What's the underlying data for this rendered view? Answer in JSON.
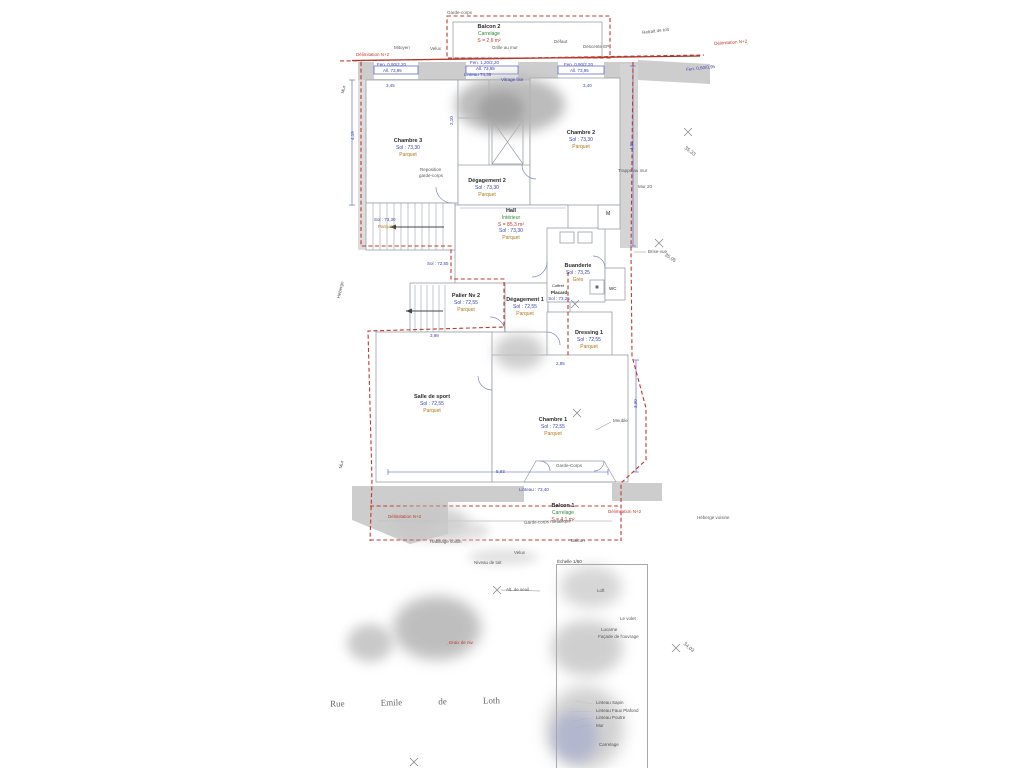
{
  "plan_colors": {
    "boundary_red": "#c0392b",
    "dimension_blue": "#3a46b4",
    "material_orange": "#b07818",
    "surface_green": "#2e8b3a",
    "wall_gray": "#cdcdcd"
  },
  "rooms": {
    "balcon2": {
      "name": "Balcon 2",
      "mat": "Carrelage",
      "surf": "S = 2,6 m²"
    },
    "chambre3": {
      "name": "Chambre 3",
      "area": "Sol : 73,30",
      "floor": "Parquet"
    },
    "chambre2": {
      "name": "Chambre 2",
      "area": "Sol : 73,30",
      "floor": "Parquet"
    },
    "degagement2": {
      "name": "Dégagement 2",
      "area": "Sol : 73,30",
      "floor": "Parquet"
    },
    "hall": {
      "name": "Hall",
      "mat": "Intérieur",
      "surf": "S = 85,3 m²",
      "area": "Sol : 73,30",
      "floor": "Parquet"
    },
    "palier": {
      "name": "Palier Nv 2",
      "area": "Sol : 72,55",
      "floor": "Parquet"
    },
    "degagement1": {
      "name": "Dégagement 1",
      "area": "Sol : 72,55",
      "floor": "Parquet"
    },
    "placard": {
      "name": "Placard",
      "area": "Sol : 73,25"
    },
    "buanderie": {
      "name": "Buanderie",
      "area": "Sol : 73,25",
      "floor": "Grès"
    },
    "dressing": {
      "name": "Dressing 1",
      "area": "Sol : 72,55",
      "floor": "Parquet"
    },
    "sport": {
      "name": "Salle de sport",
      "area": "Sol : 72,55",
      "floor": "Parquet"
    },
    "chambre1": {
      "name": "Chambre 1",
      "area": "Sol : 72,55",
      "floor": "Parquet"
    },
    "balcon1": {
      "name": "Balcon 1",
      "mat": "Carrelage",
      "surf": "S = 4,1 m²"
    }
  },
  "street": {
    "parts": [
      "Rue",
      "Emile",
      "de",
      "Loth"
    ]
  },
  "legend": {
    "header": "Échelle 1/50",
    "items": [
      "Linteau Sapin",
      "Linteau Faux Plafond",
      "Linteau Poutre",
      "Mur"
    ],
    "footer": "Carrelage"
  },
  "annotations": [
    {
      "t": "Garde-corps",
      "x": 447,
      "y": 11,
      "c": "g",
      "fs": 4.5
    },
    {
      "t": "Mitoyen",
      "x": 394,
      "y": 46,
      "c": "g",
      "fs": 4.5
    },
    {
      "t": "Velux",
      "x": 430,
      "y": 47,
      "c": "g",
      "fs": 4.5
    },
    {
      "t": "Grille au mur",
      "x": 492,
      "y": 46,
      "c": "g",
      "fs": 4.5
    },
    {
      "t": "Défaut",
      "x": 554,
      "y": 40,
      "c": "g",
      "fs": 4.5
    },
    {
      "t": "Descente EP",
      "x": 583,
      "y": 45,
      "c": "g",
      "fs": 4.5
    },
    {
      "t": "Retrait de toit",
      "x": 642,
      "y": 31,
      "r": -7,
      "c": "g",
      "fs": 4.5
    },
    {
      "t": "Trappe au mur",
      "x": 618,
      "y": 169,
      "c": "g",
      "fs": 4.5
    },
    {
      "t": "Mur 20",
      "x": 638,
      "y": 185,
      "c": "g",
      "fs": 4.5
    },
    {
      "t": "Reposition",
      "x": 420,
      "y": 168,
      "c": "g",
      "fs": 4.5
    },
    {
      "t": "garde-corps",
      "x": 419,
      "y": 174,
      "c": "g",
      "fs": 4.5
    },
    {
      "t": "Brise-vue",
      "x": 648,
      "y": 250,
      "c": "g",
      "fs": 4.5
    },
    {
      "t": "Meuble",
      "x": 613,
      "y": 419,
      "c": "g",
      "fs": 4.5
    },
    {
      "t": "Garde-Corps",
      "x": 556,
      "y": 464,
      "c": "g",
      "fs": 4.5
    },
    {
      "t": "Garde-corps métallique",
      "x": 524,
      "y": 521,
      "r": -2,
      "c": "g",
      "fs": 4.5
    },
    {
      "t": "Héberge voisine",
      "x": 697,
      "y": 516,
      "c": "g",
      "fs": 4.5
    },
    {
      "t": "Balcon",
      "x": 571,
      "y": 539,
      "c": "g",
      "fs": 4.5
    },
    {
      "t": "Habillage voisin",
      "x": 430,
      "y": 540,
      "c": "g",
      "fs": 4.5
    },
    {
      "t": "Velux",
      "x": 514,
      "y": 551,
      "c": "g",
      "fs": 4.5
    },
    {
      "t": "Niveau de toit",
      "x": 474,
      "y": 561,
      "c": "g",
      "fs": 4.5
    },
    {
      "t": "Alt. de seuil",
      "x": 506,
      "y": 588,
      "c": "g",
      "fs": 4.5
    },
    {
      "t": "Mur",
      "x": 341,
      "y": 93,
      "r": -78,
      "c": "g",
      "fs": 4.5
    },
    {
      "t": "Héberge",
      "x": 337,
      "y": 298,
      "r": -78,
      "c": "g",
      "fs": 4.5
    },
    {
      "t": "Mur",
      "x": 339,
      "y": 468,
      "r": -78,
      "c": "g",
      "fs": 4.5
    },
    {
      "t": "35,33",
      "x": 686,
      "y": 146,
      "r": 38,
      "c": "g",
      "fs": 5
    },
    {
      "t": "35,05",
      "x": 666,
      "y": 253,
      "r": 34,
      "c": "g",
      "fs": 5
    },
    {
      "t": "34,03",
      "x": 685,
      "y": 642,
      "r": 40,
      "c": "g",
      "fs": 5
    },
    {
      "t": "M",
      "x": 606,
      "y": 212,
      "c": "k",
      "fs": 5
    },
    {
      "t": "WC",
      "x": 609,
      "y": 287,
      "c": "k",
      "fs": 4.5
    },
    {
      "t": "Coffret",
      "x": 552,
      "y": 284,
      "c": "k",
      "fs": 4
    },
    {
      "t": "Délimitation N+2",
      "x": 356,
      "y": 53,
      "c": "r",
      "fs": 4.5
    },
    {
      "t": "Délimitation N+2",
      "x": 714,
      "y": 42,
      "r": -4,
      "c": "r",
      "fs": 4.5
    },
    {
      "t": "Délimitation N+2",
      "x": 388,
      "y": 515,
      "c": "r",
      "fs": 4.5
    },
    {
      "t": "Délimitation N+2",
      "x": 608,
      "y": 510,
      "c": "r",
      "fs": 4.5
    },
    {
      "t": "Croix de niv.",
      "x": 449,
      "y": 641,
      "c": "r",
      "fs": 4.5
    },
    {
      "t": "Fen. 0,90/2,20",
      "x": 377,
      "y": 63,
      "c": "b",
      "fs": 4.5
    },
    {
      "t": "All. 73,95",
      "x": 383,
      "y": 69,
      "c": "b",
      "fs": 4.5
    },
    {
      "t": "Fen. 1,20/2,20",
      "x": 470,
      "y": 61,
      "c": "b",
      "fs": 4.5
    },
    {
      "t": "All. 73,95",
      "x": 476,
      "y": 67,
      "c": "b",
      "fs": 4.5
    },
    {
      "t": "Fen. 0,90/2,20",
      "x": 564,
      "y": 63,
      "c": "b",
      "fs": 4.5
    },
    {
      "t": "All. 73,95",
      "x": 570,
      "y": 69,
      "c": "b",
      "fs": 4.5
    },
    {
      "t": "Fen. 0,60/0,95",
      "x": 686,
      "y": 68,
      "r": -6,
      "c": "b",
      "fs": 4.5
    },
    {
      "t": "Linteau 74,35",
      "x": 464,
      "y": 73,
      "c": "b",
      "fs": 4.5
    },
    {
      "t": "Vitrage fixe",
      "x": 501,
      "y": 78,
      "c": "b",
      "fs": 4.5
    },
    {
      "t": "Sol : 73,30",
      "x": 374,
      "y": 218,
      "c": "b",
      "fs": 4.5
    },
    {
      "t": "Parquet",
      "x": 378,
      "y": 225,
      "c": "o",
      "fs": 4.5
    },
    {
      "t": "Sol : 72,55",
      "x": 427,
      "y": 262,
      "c": "b",
      "fs": 4.5
    },
    {
      "t": "Linteau : 73,40",
      "x": 519,
      "y": 488,
      "c": "b",
      "fs": 4.5
    },
    {
      "t": "3,45",
      "x": 386,
      "y": 84,
      "c": "b",
      "fs": 4.5
    },
    {
      "t": "3,40",
      "x": 583,
      "y": 84,
      "c": "b",
      "fs": 4.5
    },
    {
      "t": "4,19",
      "x": 351,
      "y": 140,
      "r": -90,
      "c": "b",
      "fs": 4.5
    },
    {
      "t": "2,10",
      "x": 450,
      "y": 125,
      "r": -90,
      "c": "b",
      "fs": 4.5
    },
    {
      "t": "4,05",
      "x": 630,
      "y": 150,
      "r": -90,
      "c": "b",
      "fs": 4.5
    },
    {
      "t": "3,90",
      "x": 634,
      "y": 408,
      "r": -90,
      "c": "b",
      "fs": 4.5
    },
    {
      "t": "5,93",
      "x": 496,
      "y": 470,
      "c": "b",
      "fs": 4.5
    },
    {
      "t": "3,98",
      "x": 430,
      "y": 334,
      "c": "b",
      "fs": 4.5
    },
    {
      "t": "2,85",
      "x": 556,
      "y": 362,
      "c": "b",
      "fs": 4.5
    },
    {
      "t": "Loft",
      "x": 597,
      "y": 589,
      "c": "g",
      "fs": 4.5
    },
    {
      "t": "Le volet",
      "x": 620,
      "y": 617,
      "c": "g",
      "fs": 4.5
    },
    {
      "t": "Lucarne",
      "x": 601,
      "y": 628,
      "c": "g",
      "fs": 4.5
    },
    {
      "t": "Façade de l'ouvrage",
      "x": 598,
      "y": 635,
      "c": "g",
      "fs": 4.5
    }
  ]
}
